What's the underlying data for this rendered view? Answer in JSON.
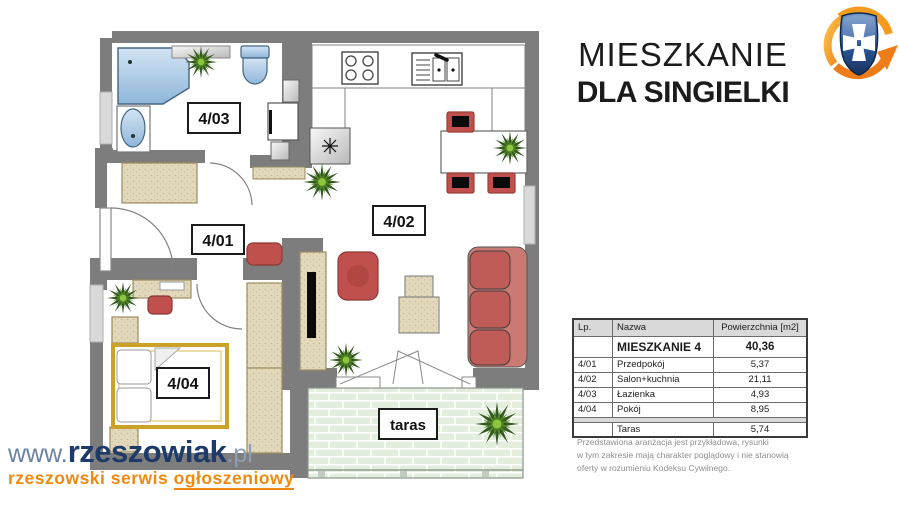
{
  "header": {
    "title_line1": "MIESZKANIE",
    "title_line2": "DLA SINGIELKI",
    "logo_icon": "rzeszow-coat-of-arms-icon"
  },
  "floor_plan": {
    "labels": {
      "hallway": "4/01",
      "living_kitchen": "4/02",
      "bathroom": "4/03",
      "bedroom": "4/04",
      "terrace": "taras"
    }
  },
  "table": {
    "columns": [
      "Lp.",
      "Nazwa",
      "Powierzchnia  [m2]"
    ],
    "summary_row": {
      "lp": "",
      "name": "MIESZKANIE  4",
      "area": "40,36"
    },
    "rows": [
      {
        "lp": "4/01",
        "name": "Przedpokój",
        "area": "5,37"
      },
      {
        "lp": "4/02",
        "name": "Salon+kuchnia",
        "area": "21,11"
      },
      {
        "lp": "4/03",
        "name": "Łazienka",
        "area": "4,93"
      },
      {
        "lp": "4/04",
        "name": "Pokój",
        "area": "8,95"
      }
    ],
    "extra_row": {
      "lp": "",
      "name": "Taras",
      "area": "5,74"
    }
  },
  "disclaimer": "Przedstawiona aranżacja jest przykładowa, rysunki\nw tym zakresie mają charakter poglądowy i nie stanowią\noferty w rozumieniu Kodeksu Cywilnego.",
  "watermark": {
    "www": "www.",
    "brand": "rzeszowiak",
    "tld": ".pl",
    "tagline_prefix": "rzeszowski serwis ",
    "tagline_underline": "ogłoszeniowy"
  },
  "colors": {
    "wall_gray": "#7d7d7d",
    "furniture_red": "#c0504d",
    "furniture_tan": "#e2d8bc",
    "fixture_blue": "#aecbe6",
    "terrace_green": "#e4eedf",
    "brand_navy": "#1d3a68",
    "brand_orange": "#ef8a10"
  }
}
